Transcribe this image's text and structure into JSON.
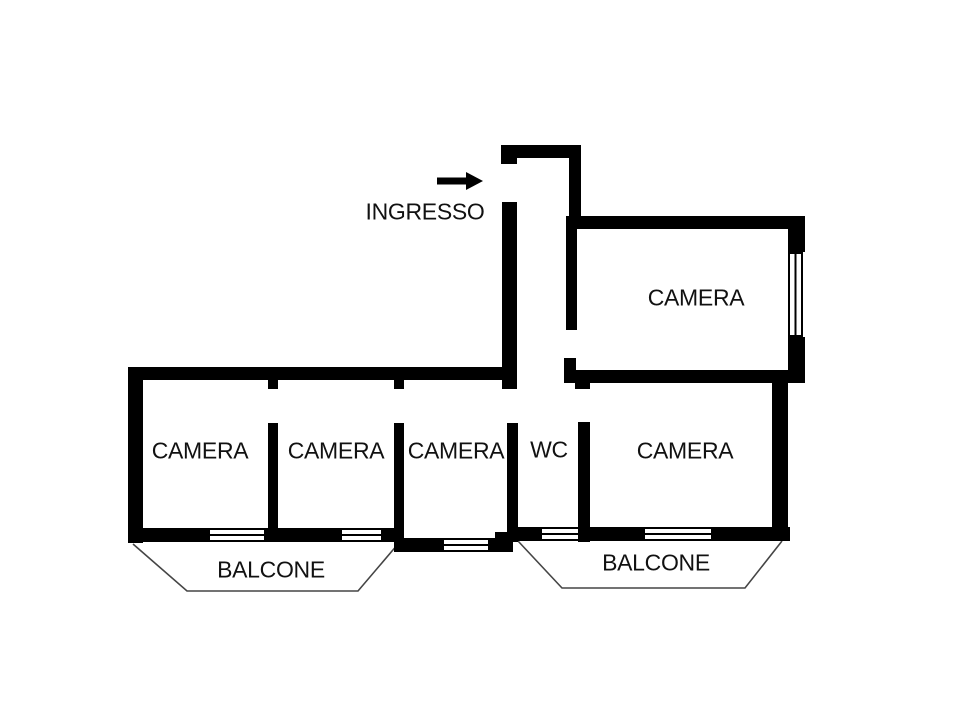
{
  "canvas": {
    "width": 960,
    "height": 720,
    "background": "#ffffff"
  },
  "colors": {
    "wall": "#000000",
    "window_line": "#000000",
    "balcony_line": "#454545",
    "text": "#111111"
  },
  "labels": {
    "entrance": {
      "text": "INGRESSO",
      "cx": 425,
      "cy": 212
    },
    "rooms": [
      {
        "name": "camera-top-right",
        "text": "CAMERA",
        "cx": 696,
        "cy": 298
      },
      {
        "name": "camera-1",
        "text": "CAMERA",
        "cx": 200,
        "cy": 451
      },
      {
        "name": "camera-2",
        "text": "CAMERA",
        "cx": 336,
        "cy": 451
      },
      {
        "name": "camera-3",
        "text": "CAMERA",
        "cx": 456,
        "cy": 451
      },
      {
        "name": "wc",
        "text": "WC",
        "cx": 549,
        "cy": 450
      },
      {
        "name": "camera-4",
        "text": "CAMERA",
        "cx": 685,
        "cy": 451
      },
      {
        "name": "balcone-left",
        "text": "BALCONE",
        "cx": 271,
        "cy": 570
      },
      {
        "name": "balcone-right",
        "text": "BALCONE",
        "cx": 656,
        "cy": 563
      }
    ]
  },
  "entrance_arrow": {
    "shaft": [
      437,
      181,
      468,
      181
    ],
    "thickness": 7,
    "head": [
      [
        466,
        172
      ],
      [
        483,
        181
      ],
      [
        466,
        190
      ]
    ]
  },
  "geometry": {
    "walls": [
      [
        501,
        145,
        80,
        13
      ],
      [
        501,
        145,
        16,
        19
      ],
      [
        569,
        146,
        12,
        72
      ],
      [
        502,
        202,
        15,
        187
      ],
      [
        566,
        216,
        239,
        13
      ],
      [
        566,
        229,
        11,
        101
      ],
      [
        564,
        358,
        12,
        25
      ],
      [
        788,
        216,
        17,
        36
      ],
      [
        788,
        337,
        17,
        36
      ],
      [
        566,
        370,
        239,
        13
      ],
      [
        575,
        381,
        15,
        8
      ],
      [
        772,
        383,
        16,
        157
      ],
      [
        128,
        367,
        388,
        13
      ],
      [
        128,
        367,
        15,
        176
      ],
      [
        268,
        378,
        10,
        11
      ],
      [
        268,
        423,
        10,
        117
      ],
      [
        394,
        378,
        10,
        11
      ],
      [
        394,
        423,
        10,
        129
      ],
      [
        507,
        423,
        11,
        119
      ],
      [
        578,
        422,
        12,
        120
      ],
      [
        128,
        528,
        80,
        14
      ],
      [
        266,
        528,
        74,
        14
      ],
      [
        383,
        528,
        17,
        14
      ],
      [
        400,
        538,
        42,
        14
      ],
      [
        490,
        538,
        23,
        14
      ],
      [
        495,
        532,
        18,
        20
      ],
      [
        513,
        527,
        27,
        14
      ],
      [
        588,
        527,
        55,
        14
      ],
      [
        713,
        527,
        77,
        14
      ]
    ],
    "windows": [
      {
        "x": 208,
        "y": 528,
        "w": 58,
        "h": 14,
        "o": "h"
      },
      {
        "x": 340,
        "y": 528,
        "w": 43,
        "h": 14,
        "o": "h"
      },
      {
        "x": 442,
        "y": 538,
        "w": 48,
        "h": 14,
        "o": "h"
      },
      {
        "x": 540,
        "y": 527,
        "w": 40,
        "h": 14,
        "o": "h"
      },
      {
        "x": 643,
        "y": 527,
        "w": 70,
        "h": 14,
        "o": "h"
      },
      {
        "x": 788,
        "y": 252,
        "w": 15,
        "h": 85,
        "o": "v"
      }
    ],
    "balconies": [
      {
        "name": "balcone-left-outline",
        "points": [
          [
            133,
            544
          ],
          [
            187,
            591
          ],
          [
            358,
            591
          ],
          [
            398,
            544
          ]
        ]
      },
      {
        "name": "balcone-right-outline",
        "points": [
          [
            518,
            541
          ],
          [
            562,
            588
          ],
          [
            745,
            588
          ],
          [
            782,
            541
          ]
        ]
      }
    ]
  }
}
